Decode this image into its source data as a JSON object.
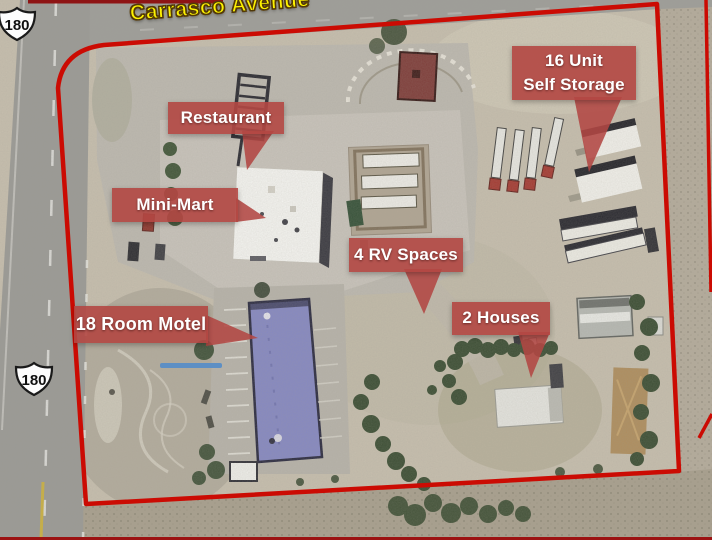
{
  "street": {
    "name": "Carrasco Avenue"
  },
  "highway": {
    "route": "180"
  },
  "callouts": {
    "restaurant": "Restaurant",
    "mini_mart": "Mini-Mart",
    "self_storage": {
      "line1": "16 Unit",
      "line2": "Self Storage"
    },
    "rv_spaces": "4 RV Spaces",
    "motel": "18 Room Motel",
    "houses": "2 Houses"
  },
  "colors": {
    "property_boundary": "#cb0b03",
    "callout_background": "#b24744",
    "callout_text": "#ffffff",
    "street_label": "#fef200",
    "motel_roof": "#8487c5",
    "underline": "#5d8fc4"
  }
}
